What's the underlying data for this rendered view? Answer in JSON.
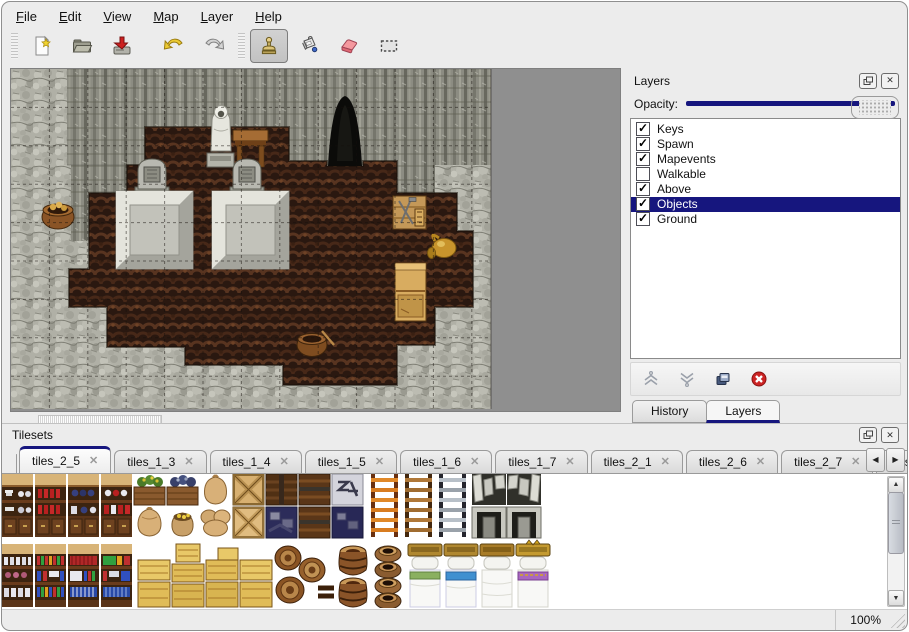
{
  "menu": {
    "items": [
      {
        "label": "File"
      },
      {
        "label": "Edit"
      },
      {
        "label": "View"
      },
      {
        "label": "Map"
      },
      {
        "label": "Layer"
      },
      {
        "label": "Help"
      }
    ]
  },
  "toolbar": {
    "buttons": [
      "new-file",
      "open-file",
      "save-file",
      "undo",
      "redo",
      "stamp-tool",
      "fill-tool",
      "eraser-tool",
      "select-tool"
    ],
    "active_tool": "stamp-tool"
  },
  "map_view": {
    "grid": "on",
    "objects": [
      "rock-wall",
      "rubble-ground",
      "dirt-floor",
      "cave-entrance",
      "hooded-statue",
      "wooden-table",
      "gravestone-left",
      "gravestone-right",
      "stone-tomb-left",
      "stone-tomb-right",
      "supply-crate",
      "golden-ewer",
      "wooden-cabinet",
      "washtub-left",
      "washtub-bottom"
    ]
  },
  "layers_panel": {
    "title": "Layers",
    "opacity": {
      "label": "Opacity:",
      "value_fraction": 1
    },
    "layers": [
      {
        "name": "Keys",
        "check": "✓"
      },
      {
        "name": "Spawn",
        "check": "✓"
      },
      {
        "name": "Mapevents",
        "check": "✓"
      },
      {
        "name": "Walkable",
        "check": ""
      },
      {
        "name": "Above",
        "check": "✓"
      },
      {
        "name": "Objects",
        "check": "✓",
        "selected": true
      },
      {
        "name": "Ground",
        "check": "✓"
      }
    ],
    "buttons": [
      "raise-layer",
      "lower-layer",
      "duplicate-layer",
      "delete-layer"
    ],
    "tabs": [
      {
        "label": "History",
        "active": false
      },
      {
        "label": "Layers",
        "active": true
      }
    ]
  },
  "tilesets_panel": {
    "title": "Tilesets",
    "tabs": [
      {
        "label": "tiles_2_5",
        "active": true
      },
      {
        "label": "tiles_1_3"
      },
      {
        "label": "tiles_1_4"
      },
      {
        "label": "tiles_1_5"
      },
      {
        "label": "tiles_1_6"
      },
      {
        "label": "tiles_1_7"
      },
      {
        "label": "tiles_2_1"
      },
      {
        "label": "tiles_2_6"
      },
      {
        "label": "tiles_2_7"
      },
      {
        "label": "tiles_",
        "partial": true
      }
    ],
    "tiles": [
      "shelf-with-dishes",
      "shelf-with-red-bottles",
      "shelf-with-blue-pots",
      "shelf-with-jars",
      "planter-yellow-flowers",
      "planter-dark",
      "sack",
      "open-sack-with-gold",
      "tall-sack",
      "sack-pile",
      "crossed-plank-crate",
      "crossed-plank-crate-light",
      "dark-plank-crate",
      "navy-crate-pile",
      "banded-plank-crate",
      "stone-sign-tile",
      "orange-ladder",
      "brown-ladder",
      "iron-ladder",
      "stone-arch",
      "stone-doorway",
      "stone-doorway-2",
      "bookshelf-bottles-1",
      "bookshelf-bottles-2",
      "bookshelf-bottles-3",
      "bookshelf-bottles-4",
      "yellow-crate",
      "yellow-crate-stack",
      "yellow-crate-pair",
      "yellow-crate-group",
      "tipped-barrels",
      "upright-barrels",
      "clay-pot-stack",
      "bed-green",
      "bed-blue",
      "bed-white",
      "bed-purple"
    ]
  },
  "status_bar": {
    "zoom_level": "100%"
  },
  "icons": {
    "close": "✕",
    "check": "✓",
    "up": "▲",
    "down": "▼",
    "left": "◀",
    "right": "▶"
  },
  "colors": {
    "accent": "#16167e",
    "selection": "#16167e",
    "window_bg": "#ececec",
    "canvas_bg": "#8f8f8f"
  }
}
